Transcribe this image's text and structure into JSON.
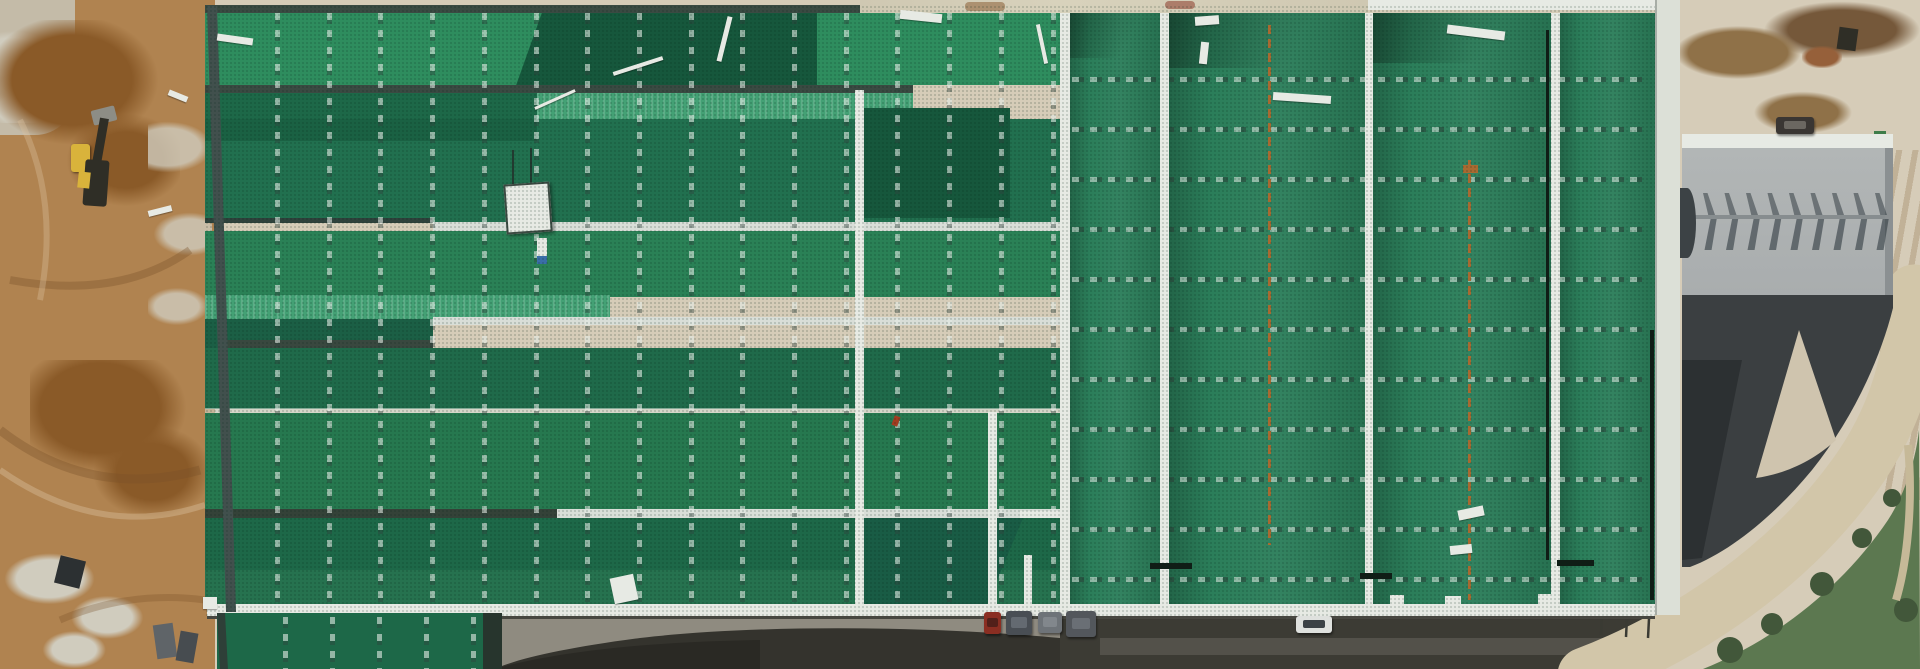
{
  "scene": {
    "description": "Aerial drone photograph of a large industrial warehouse under construction: wide green metal roof with seam markings, brown earthworks and a yellow wheel loader on the left, a gray factory building with sawtooth roof shadows and concrete apron on the right, access road with trucks and a white car along the bottom"
  },
  "palette": {
    "dirt": "#b08350",
    "dirt_dark": "#8a5a28",
    "dirt_light": "#c9a36b",
    "gravel": "#c4bba8",
    "rock_white": "#d0ccbe",
    "debris_gray": "#b9b5a7",
    "roof_bright": "#2e8d5e",
    "roof_medium": "#26784f",
    "roof_mid2": "#21704f",
    "roof_dark": "#1d6848",
    "roof_darker": "#1b5f45",
    "roof_darkest": "#16573c",
    "roof_teal": "#44a175",
    "ridge_slate": "#3a4a42",
    "ridge_dark": "#2f423c",
    "strip_silver": "#d9ded8",
    "strip_white": "#e7eae4",
    "parapet_dirty": "#cfc8b2",
    "parapet_right": "#dce0d7",
    "rust": "#a86a31",
    "black_mark": "#101d16",
    "concrete": "#d6ccb8",
    "mud": "#8f7148",
    "mud_dark": "#75583a",
    "gray_roof": "#a9adae",
    "gray_roof_dark": "#3b3f41",
    "charcoal_dark": "#2c3032",
    "asphalt": "#34332d",
    "asphalt2": "#3c3b34",
    "asphalt_dark": "#2a2924",
    "road_light": "#8f8b80",
    "road_mid": "#53514a",
    "vegetation": "#5c7850",
    "veg_dark": "#42573a",
    "road_tan": "#d2c6a9",
    "excavator_yellow": "#d9b33b",
    "machine_dark": "#2f2e26",
    "machine_gray": "#8d8d85",
    "truck_red": "#8a2e22",
    "car_white": "#dfe1de",
    "suv_dark": "#3a3633"
  },
  "left_roof_seams": {
    "start_x": 275,
    "spacing": 51.7,
    "count": 16,
    "width": 5,
    "top": 13,
    "height": 591
  },
  "right_roof_seams": {
    "left": 1072,
    "width": 576,
    "start_y": 77,
    "spacing": 50,
    "count": 11,
    "height": 5
  },
  "wing_seams": {
    "start_x": 283,
    "spacing": 47,
    "count": 5,
    "width": 5,
    "top": 617,
    "height": 52
  },
  "gray_roof_teeth": {
    "start_x": 1700,
    "spacing": 21.5,
    "count": 9,
    "upper_y": 193,
    "upper_h": 22,
    "lower_y": 219,
    "lower_h": 31,
    "width": 15
  },
  "debris_planks": [
    {
      "x": 217,
      "y": 36,
      "w": 36,
      "h": 7,
      "rot": 8
    },
    {
      "x": 533,
      "y": 98,
      "w": 44,
      "h": 3,
      "rot": -24
    },
    {
      "x": 612,
      "y": 64,
      "w": 52,
      "h": 4,
      "rot": -18
    },
    {
      "x": 722,
      "y": 16,
      "w": 5,
      "h": 46,
      "rot": 14
    },
    {
      "x": 900,
      "y": 12,
      "w": 42,
      "h": 9,
      "rot": 6
    },
    {
      "x": 1040,
      "y": 24,
      "w": 4,
      "h": 40,
      "rot": -12
    },
    {
      "x": 1195,
      "y": 16,
      "w": 24,
      "h": 9,
      "rot": -4
    },
    {
      "x": 1200,
      "y": 42,
      "w": 8,
      "h": 22,
      "rot": 6
    },
    {
      "x": 1447,
      "y": 28,
      "w": 58,
      "h": 9,
      "rot": 7
    },
    {
      "x": 1273,
      "y": 94,
      "w": 58,
      "h": 8,
      "rot": 4
    },
    {
      "x": 1458,
      "y": 508,
      "w": 26,
      "h": 10,
      "rot": -12
    },
    {
      "x": 1450,
      "y": 545,
      "w": 22,
      "h": 9,
      "rot": -6
    },
    {
      "x": 612,
      "y": 576,
      "w": 24,
      "h": 26,
      "rot": -12
    },
    {
      "x": 203,
      "y": 597,
      "w": 14,
      "h": 12,
      "rot": 0
    },
    {
      "x": 168,
      "y": 93,
      "w": 20,
      "h": 6,
      "rot": 22
    },
    {
      "x": 148,
      "y": 208,
      "w": 24,
      "h": 6,
      "rot": -14
    }
  ],
  "vehicles": [
    {
      "name": "red-truck-cab",
      "x": 984,
      "y": 612,
      "w": 17,
      "h": 22,
      "color": "#8a2e22",
      "win": "#52201a"
    },
    {
      "name": "container-1",
      "x": 1006,
      "y": 611,
      "w": 26,
      "h": 24,
      "color": "#494e54",
      "win": "#646a71"
    },
    {
      "name": "container-2",
      "x": 1038,
      "y": 612,
      "w": 24,
      "h": 21,
      "color": "#6e7378",
      "win": "#82878c"
    },
    {
      "name": "container-3",
      "x": 1066,
      "y": 611,
      "w": 30,
      "h": 26,
      "color": "#53575c",
      "win": "#6a6f75"
    },
    {
      "name": "white-car",
      "x": 1296,
      "y": 616,
      "w": 36,
      "h": 17,
      "color": "#dfe1de",
      "win": "#3c4246"
    },
    {
      "name": "dark-suv",
      "x": 1776,
      "y": 117,
      "w": 38,
      "h": 17,
      "color": "#3a3633",
      "win": "#6b6761"
    }
  ]
}
